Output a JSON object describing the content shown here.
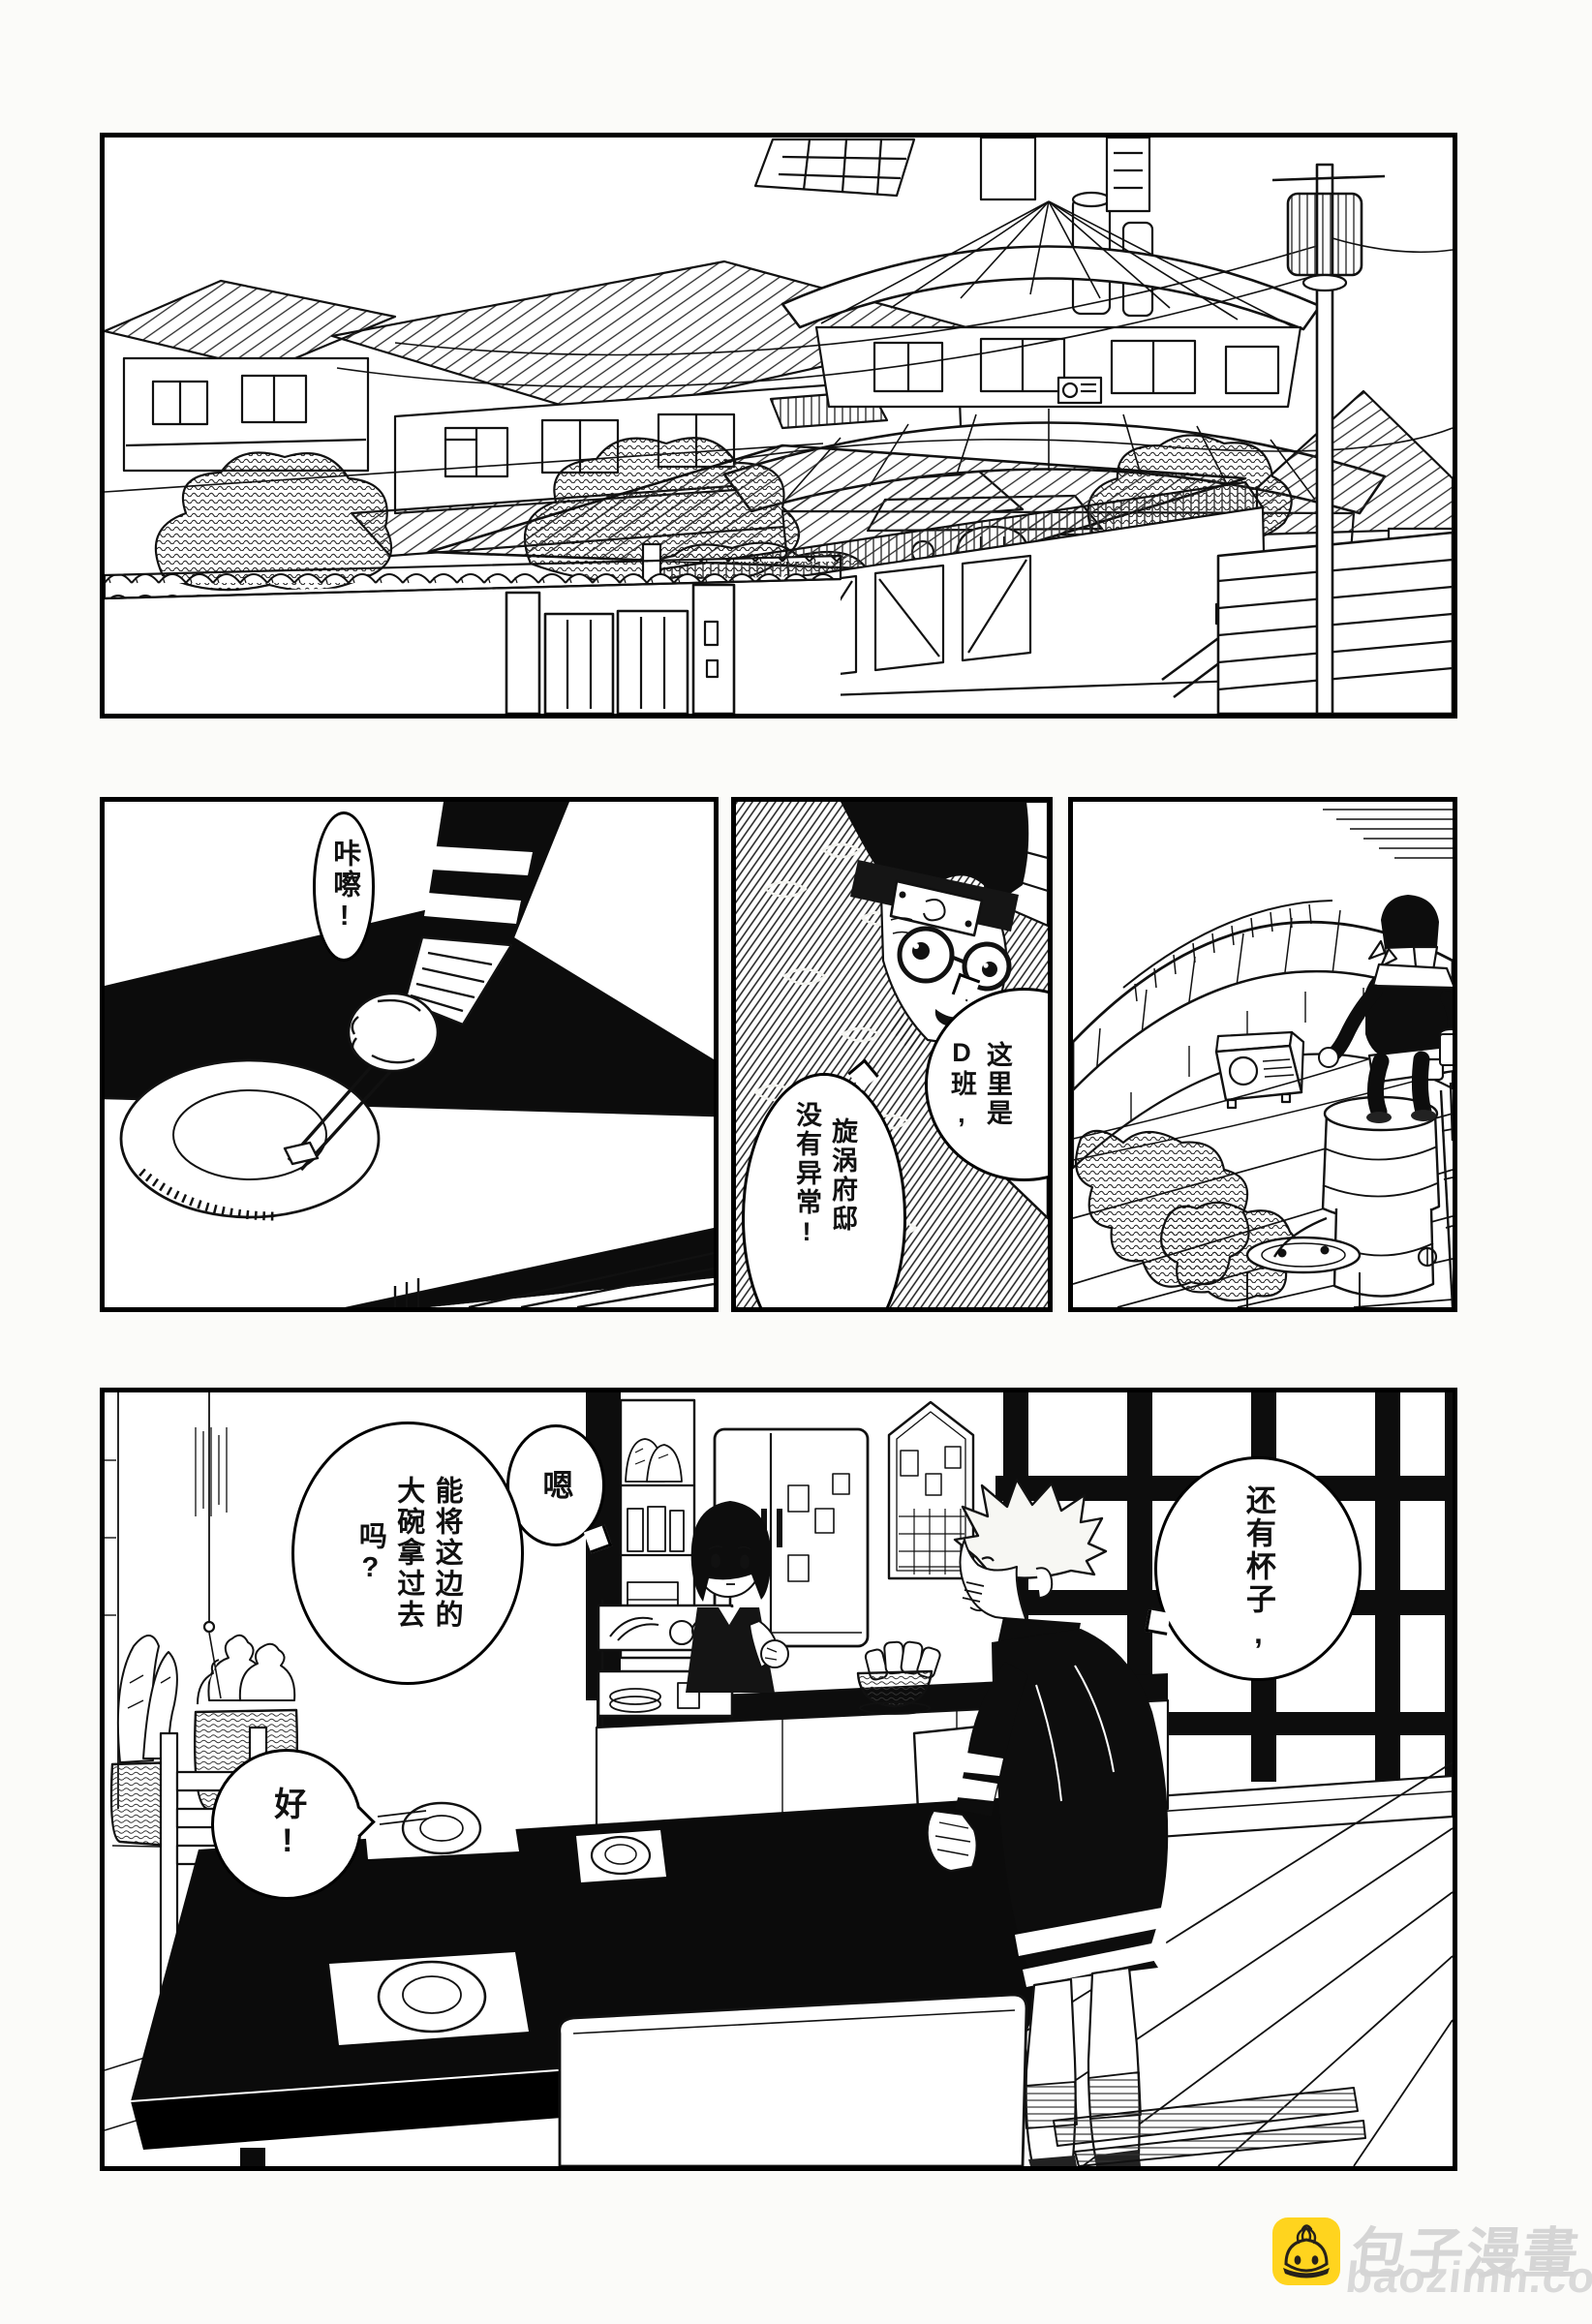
{
  "page": {
    "paper": "#ffffff",
    "ink": "#0d0d0d"
  },
  "bubbles": {
    "katcha": {
      "text": "咔嚓!"
    },
    "team_d": {
      "cols": [
        "这里是",
        "D班,"
      ]
    },
    "residence": {
      "cols": [
        "旋涡府邸",
        "没有异常!"
      ]
    },
    "en": {
      "text": "嗯"
    },
    "request": {
      "cols": [
        "能将这边的",
        "大碗拿过去",
        "吗?"
      ]
    },
    "cups": {
      "text": "还有杯子,"
    },
    "ok": {
      "text": "好!"
    }
  },
  "watermark": {
    "site_name": "包子漫畫",
    "site_url": "baozimh.com",
    "icon": "bun-icon",
    "icon_bg": "#ffd41e",
    "icon_ink": "#26211a",
    "text_color": "#cfcfcf"
  }
}
